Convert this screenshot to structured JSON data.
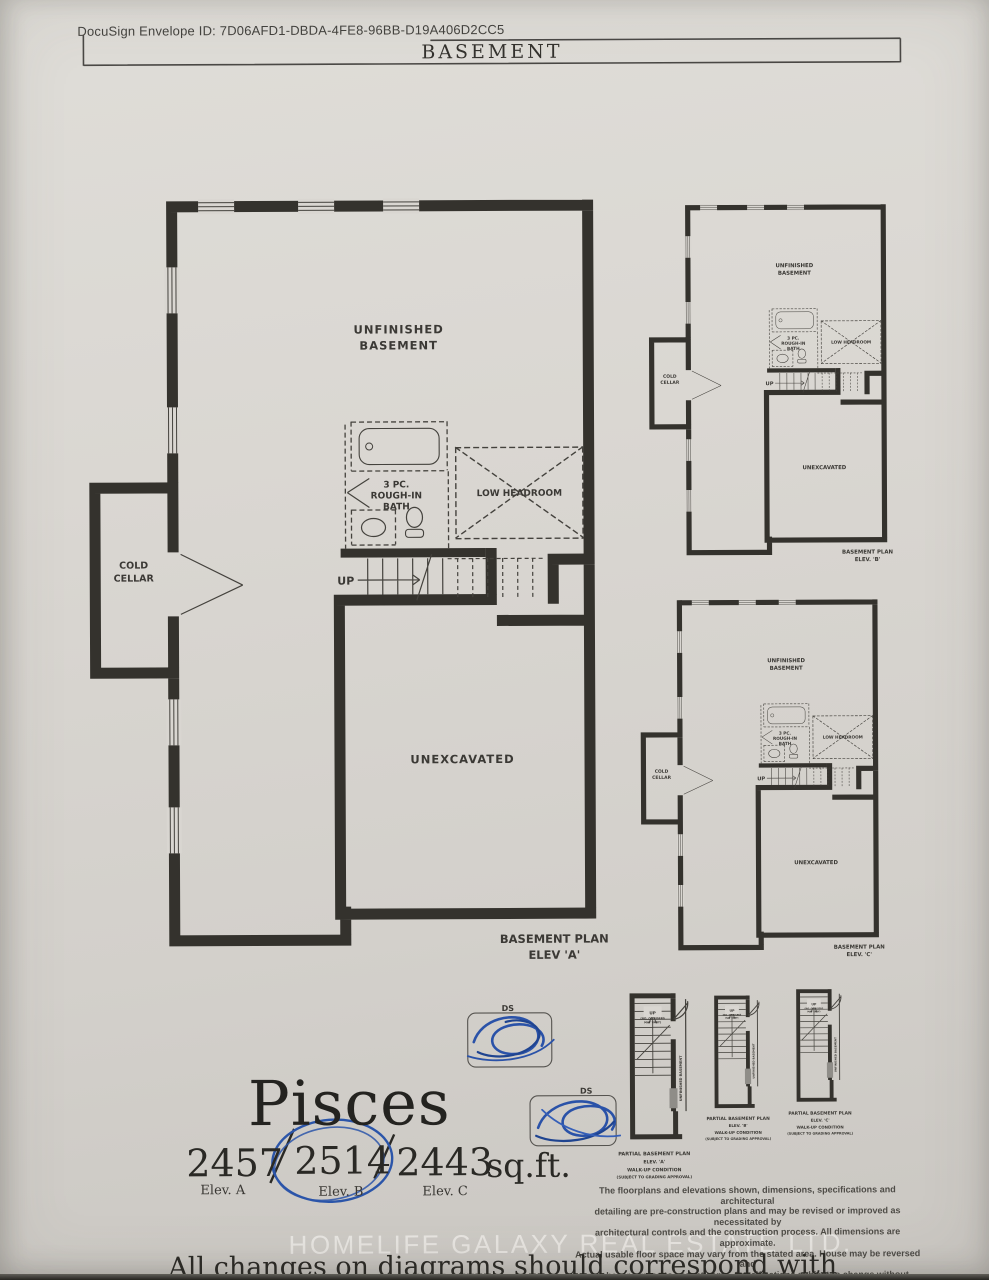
{
  "page": {
    "docusign_line": "DocuSign Envelope ID: 7D06AFD1-DBDA-4FE8-96BB-D19A406D2CC5",
    "sheet_title": "BASEMENT",
    "watermark": "HOMELIFE GALAXY REAL ESTATE LTD.",
    "footer_note": "All changes on diagrams should correspond with items in the schedule"
  },
  "model": {
    "name": "Pisces",
    "sqft_values": [
      "2457",
      "2514",
      "2443"
    ],
    "sqft_unit": "sq.ft.",
    "elev_labels": [
      "Elev. A",
      "Elev. B",
      "Elev. C"
    ],
    "selected_value": "2514",
    "selected_elev": "Elev. B"
  },
  "plan_labels": {
    "unfinished_l1": "UNFINISHED",
    "unfinished_l2": "BASEMENT",
    "cold_l1": "COLD",
    "cold_l2": "CELLAR",
    "bath_l1": "3 PC.",
    "bath_l2": "ROUGH-IN",
    "bath_l3": "BATH",
    "low_headroom": "LOW HEADROOM",
    "up": "UP",
    "unexcavated": "UNEXCAVATED"
  },
  "captions": {
    "main_l1": "BASEMENT PLAN",
    "main_l2": "ELEV 'A'",
    "b_l1": "BASEMENT PLAN",
    "b_l2": "ELEV. 'B'",
    "c_l1": "BASEMENT PLAN",
    "c_l2": "ELEV. 'C'"
  },
  "partial_plans": [
    {
      "up": "UP",
      "risers_l1": "(NO. OF RISERS",
      "risers_l2": "MAY VARY)",
      "side_text": "UNFINISHED BASEMENT",
      "cap_l1": "PARTIAL BASEMENT PLAN",
      "cap_l2": "ELEV. 'A'",
      "cap_l3": "WALK-UP CONDITION",
      "cap_l4": "(SUBJECT TO GRADING APPROVAL)"
    },
    {
      "up": "UP",
      "risers_l1": "(NO. OF RISERS",
      "risers_l2": "MAY VARY)",
      "side_text": "UNFINISHED BASEMENT",
      "cap_l1": "PARTIAL BASEMENT PLAN",
      "cap_l2": "ELEV. 'B'",
      "cap_l3": "WALK-UP CONDITION",
      "cap_l4": "(SUBJECT TO GRADING APPROVAL)"
    },
    {
      "up": "UP",
      "risers_l1": "(NO. OF RISERS",
      "risers_l2": "MAY VARY)",
      "side_text": "UNFINISHED BASEMENT",
      "cap_l1": "PARTIAL BASEMENT PLAN",
      "cap_l2": "ELEV. 'C'",
      "cap_l3": "WALK-UP CONDITION",
      "cap_l4": "(SUBJECT TO GRADING APPROVAL)"
    }
  ],
  "initials": {
    "ds_label": "DS"
  },
  "disclaimer": {
    "lines": [
      "The floorplans and elevations shown, dimensions, specifications and architectural",
      "detailing are pre-construction plans and may be revised or improved as necessitated by",
      "architectural controls and the construction process. All dimensions are approximate.",
      "Actual usable floor space may vary from the stated area. House may be reversed and",
      "purchaser agrees to accept same. Specifications subject to change without notice.",
      "Steps may vary at any exterior entrance. Illustrations are Artist's concept.",
      "Exterior railings on plans only as required by grade. E. & O.E. 03/21"
    ]
  },
  "colors": {
    "paper": "#d9d6d1",
    "ink": "#34322d",
    "pen_blue": "#2b55a9",
    "watermark": "rgba(249,248,244,0.58)"
  }
}
